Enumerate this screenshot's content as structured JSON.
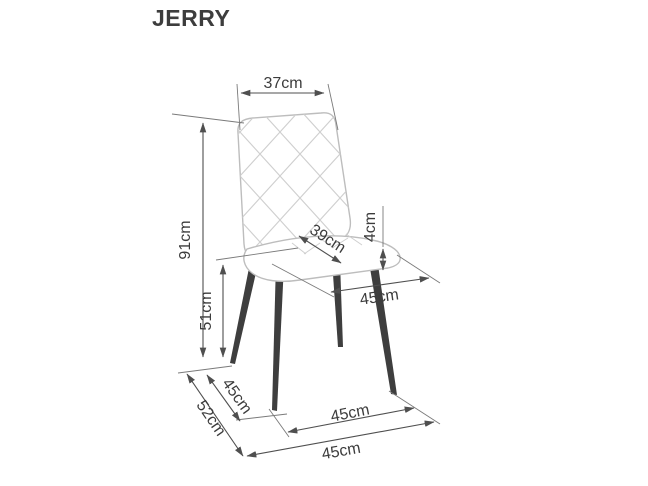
{
  "header": {
    "title": "JERRY"
  },
  "diagram": {
    "type": "product-dimension-drawing",
    "subject": "dining chair with diamond-quilted backrest, upholstered seat and four tapered metal legs",
    "units": "cm",
    "labels": {
      "backrest_width": "37cm",
      "total_height": "91cm",
      "seat_height": "51cm",
      "seat_depth": "39cm",
      "seat_thickness": "4cm",
      "seat_width": "45cm",
      "side_leg_span": "45cm",
      "base_depth": "52cm",
      "front_leg_span": "45cm",
      "base_width": "45cm"
    },
    "measurements": [
      {
        "id": "backrest-width",
        "value": 37,
        "unit": "cm",
        "what": "backrest width (top)"
      },
      {
        "id": "total-height",
        "value": 91,
        "unit": "cm",
        "what": "total chair height"
      },
      {
        "id": "seat-height",
        "value": 51,
        "unit": "cm",
        "what": "floor to seat height"
      },
      {
        "id": "seat-depth",
        "value": 39,
        "unit": "cm",
        "what": "seat depth"
      },
      {
        "id": "seat-thickness",
        "value": 4,
        "unit": "cm",
        "what": "seat cushion thickness"
      },
      {
        "id": "seat-width",
        "value": 45,
        "unit": "cm",
        "what": "seat width"
      },
      {
        "id": "side-leg-span",
        "value": 45,
        "unit": "cm",
        "what": "side leg span at floor"
      },
      {
        "id": "base-depth",
        "value": 52,
        "unit": "cm",
        "what": "overall base depth at floor"
      },
      {
        "id": "front-leg-span",
        "value": 45,
        "unit": "cm",
        "what": "front leg span at floor"
      },
      {
        "id": "base-width",
        "value": 45,
        "unit": "cm",
        "what": "overall base width at floor"
      }
    ],
    "colors": {
      "background": "#ffffff",
      "chair_outline": "#bdbdbd",
      "quilt_pattern": "#cfcfcf",
      "legs": "#3e3e3e",
      "dimension_lines": "#4f4f4f",
      "text": "#3c3c3c"
    }
  }
}
